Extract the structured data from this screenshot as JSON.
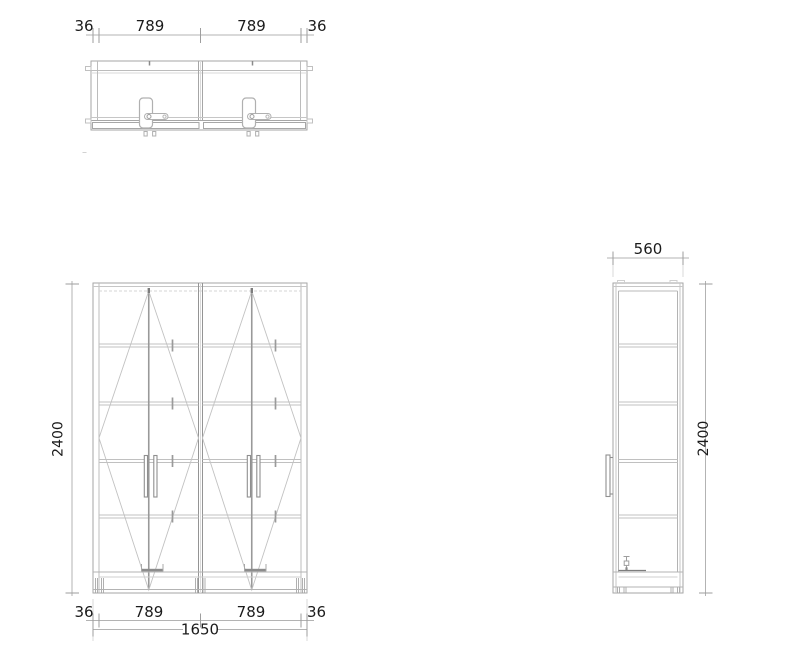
{
  "drawing": {
    "type": "furniture-technical-drawing",
    "views": {
      "plan": "two-door wardrobe top view",
      "front": "two-section wardrobe front elevation",
      "side": "wardrobe side elevation"
    },
    "colors": {
      "background": "#ffffff",
      "line_main": "#a6a6a6",
      "line_light": "#c6c6c6",
      "line_dark": "#8a8a8a",
      "dim_line": "#b3b3b3",
      "dim_tick": "#9e9e9e",
      "text": "#1b1b1b"
    },
    "dims": {
      "top": [
        "36",
        "789",
        "789",
        "36"
      ],
      "bottom": [
        "36",
        "789",
        "789",
        "36"
      ],
      "bottom_total": "1650",
      "front_height": "2400",
      "side_width": "560",
      "side_height": "2400"
    }
  }
}
